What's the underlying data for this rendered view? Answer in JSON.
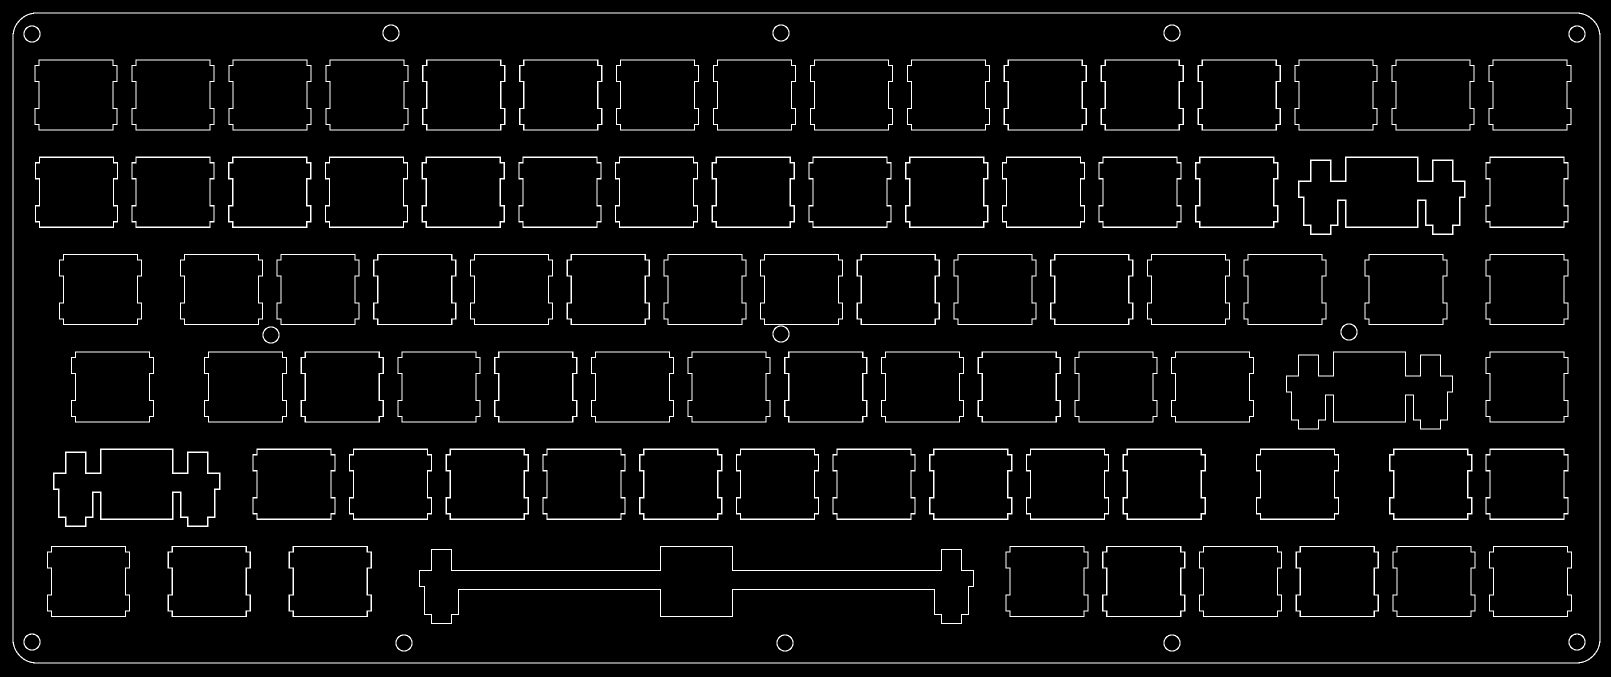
{
  "scene": {
    "description": "CAD outline drawing of a laser-cut 75% mechanical keyboard switch plate (84 switch cutouts, stabilizer cutouts, screw holes)",
    "background_color": "#000000",
    "line_color": "#ffffff",
    "line_width": 1.2
  },
  "canvas": {
    "width": 1611,
    "height": 677
  },
  "plate_outline": {
    "x": 13,
    "y": 13,
    "width": 1587,
    "height": 650,
    "corner_radius": 24
  },
  "switch_cutout": {
    "width": 74,
    "height": 70,
    "notch_depth": 4,
    "notch_inset": 5.5,
    "notch_length": 16
  },
  "stab_cutout": {
    "rect_half_width": 36,
    "tab_half_width": 10,
    "body_half_width": 17,
    "wing_half_width": 22,
    "tab_top": 3,
    "body_top": 24,
    "wing_bottom": 40,
    "channel_bottom": 43,
    "body_bottom": 68,
    "tab_bottom": 77
  },
  "rows": [
    {
      "name": "function-row",
      "cutout_top": 60,
      "keys": [
        {
          "cx": 76.1,
          "type": "switch"
        },
        {
          "cx": 173.0,
          "type": "switch"
        },
        {
          "cx": 269.9,
          "type": "switch"
        },
        {
          "cx": 366.9,
          "type": "switch"
        },
        {
          "cx": 463.8,
          "type": "switch"
        },
        {
          "cx": 560.7,
          "type": "switch"
        },
        {
          "cx": 657.6,
          "type": "switch"
        },
        {
          "cx": 754.6,
          "type": "switch"
        },
        {
          "cx": 851.5,
          "type": "switch"
        },
        {
          "cx": 948.4,
          "type": "switch"
        },
        {
          "cx": 1045.3,
          "type": "switch"
        },
        {
          "cx": 1142.3,
          "type": "switch"
        },
        {
          "cx": 1239.2,
          "type": "switch"
        },
        {
          "cx": 1336.1,
          "type": "switch"
        },
        {
          "cx": 1433.0,
          "type": "switch"
        },
        {
          "cx": 1530.0,
          "type": "switch"
        }
      ]
    },
    {
      "name": "number-row",
      "cutout_top": 157.3,
      "keys": [
        {
          "cx": 76.4,
          "type": "switch"
        },
        {
          "cx": 173.1,
          "type": "switch"
        },
        {
          "cx": 269.8,
          "type": "switch"
        },
        {
          "cx": 366.5,
          "type": "switch"
        },
        {
          "cx": 463.2,
          "type": "switch"
        },
        {
          "cx": 559.9,
          "type": "switch"
        },
        {
          "cx": 656.6,
          "type": "switch"
        },
        {
          "cx": 753.3,
          "type": "switch"
        },
        {
          "cx": 850.0,
          "type": "switch"
        },
        {
          "cx": 946.7,
          "type": "switch"
        },
        {
          "cx": 1043.4,
          "type": "switch"
        },
        {
          "cx": 1140.1,
          "type": "switch"
        },
        {
          "cx": 1236.8,
          "type": "switch"
        },
        {
          "cx": 1381.8,
          "type": "stab",
          "span": 61
        },
        {
          "cx": 1526.9,
          "type": "switch"
        }
      ]
    },
    {
      "name": "tab-row",
      "cutout_top": 254.6,
      "keys": [
        {
          "cx": 100.5,
          "type": "switch"
        },
        {
          "cx": 221.4,
          "type": "switch"
        },
        {
          "cx": 318.1,
          "type": "switch"
        },
        {
          "cx": 414.8,
          "type": "switch"
        },
        {
          "cx": 511.5,
          "type": "switch"
        },
        {
          "cx": 608.2,
          "type": "switch"
        },
        {
          "cx": 704.9,
          "type": "switch"
        },
        {
          "cx": 801.6,
          "type": "switch"
        },
        {
          "cx": 898.3,
          "type": "switch"
        },
        {
          "cx": 995.0,
          "type": "switch"
        },
        {
          "cx": 1091.7,
          "type": "switch"
        },
        {
          "cx": 1188.4,
          "type": "switch"
        },
        {
          "cx": 1285.1,
          "type": "switch"
        },
        {
          "cx": 1406.0,
          "type": "switch"
        },
        {
          "cx": 1526.9,
          "type": "switch"
        }
      ]
    },
    {
      "name": "caps-row",
      "cutout_top": 352.0,
      "keys": [
        {
          "cx": 112.6,
          "type": "switch"
        },
        {
          "cx": 245.6,
          "type": "switch"
        },
        {
          "cx": 342.3,
          "type": "switch"
        },
        {
          "cx": 439.0,
          "type": "switch"
        },
        {
          "cx": 535.7,
          "type": "switch"
        },
        {
          "cx": 632.4,
          "type": "switch"
        },
        {
          "cx": 729.1,
          "type": "switch"
        },
        {
          "cx": 825.8,
          "type": "switch"
        },
        {
          "cx": 922.5,
          "type": "switch"
        },
        {
          "cx": 1019.2,
          "type": "switch"
        },
        {
          "cx": 1115.9,
          "type": "switch"
        },
        {
          "cx": 1212.6,
          "type": "switch"
        },
        {
          "cx": 1369.6,
          "type": "stab",
          "span": 61
        },
        {
          "cx": 1526.9,
          "type": "switch"
        }
      ]
    },
    {
      "name": "shift-row",
      "cutout_top": 449.3,
      "keys": [
        {
          "cx": 136.8,
          "type": "stab",
          "span": 61
        },
        {
          "cx": 293.9,
          "type": "switch"
        },
        {
          "cx": 390.6,
          "type": "switch"
        },
        {
          "cx": 487.3,
          "type": "switch"
        },
        {
          "cx": 584.0,
          "type": "switch"
        },
        {
          "cx": 680.7,
          "type": "switch"
        },
        {
          "cx": 777.4,
          "type": "switch"
        },
        {
          "cx": 874.1,
          "type": "switch"
        },
        {
          "cx": 970.8,
          "type": "switch"
        },
        {
          "cx": 1067.5,
          "type": "switch"
        },
        {
          "cx": 1164.2,
          "type": "switch"
        },
        {
          "cx": 1297.4,
          "type": "switch"
        },
        {
          "cx": 1430.7,
          "type": "switch"
        },
        {
          "cx": 1527.1,
          "type": "switch"
        }
      ]
    },
    {
      "name": "bottom-row",
      "cutout_top": 546.6,
      "keys": [
        {
          "cx": 88.4,
          "type": "switch"
        },
        {
          "cx": 209.3,
          "type": "switch"
        },
        {
          "cx": 330.2,
          "type": "switch"
        },
        {
          "cx": 696.4,
          "type": "stab",
          "span": 255
        },
        {
          "cx": 1047.1,
          "type": "switch"
        },
        {
          "cx": 1143.8,
          "type": "switch"
        },
        {
          "cx": 1240.5,
          "type": "switch"
        },
        {
          "cx": 1337.2,
          "type": "switch"
        },
        {
          "cx": 1433.9,
          "type": "switch"
        },
        {
          "cx": 1530.6,
          "type": "switch"
        }
      ]
    }
  ],
  "screw_holes": {
    "radius": 8,
    "positions": [
      [
        32,
        34
      ],
      [
        391,
        33
      ],
      [
        781,
        33
      ],
      [
        1172,
        33
      ],
      [
        1577,
        34
      ],
      [
        271,
        335
      ],
      [
        781,
        334
      ],
      [
        1349,
        332
      ],
      [
        32,
        642
      ],
      [
        404,
        643
      ],
      [
        785,
        643
      ],
      [
        1172,
        643
      ],
      [
        1577,
        642
      ]
    ]
  }
}
